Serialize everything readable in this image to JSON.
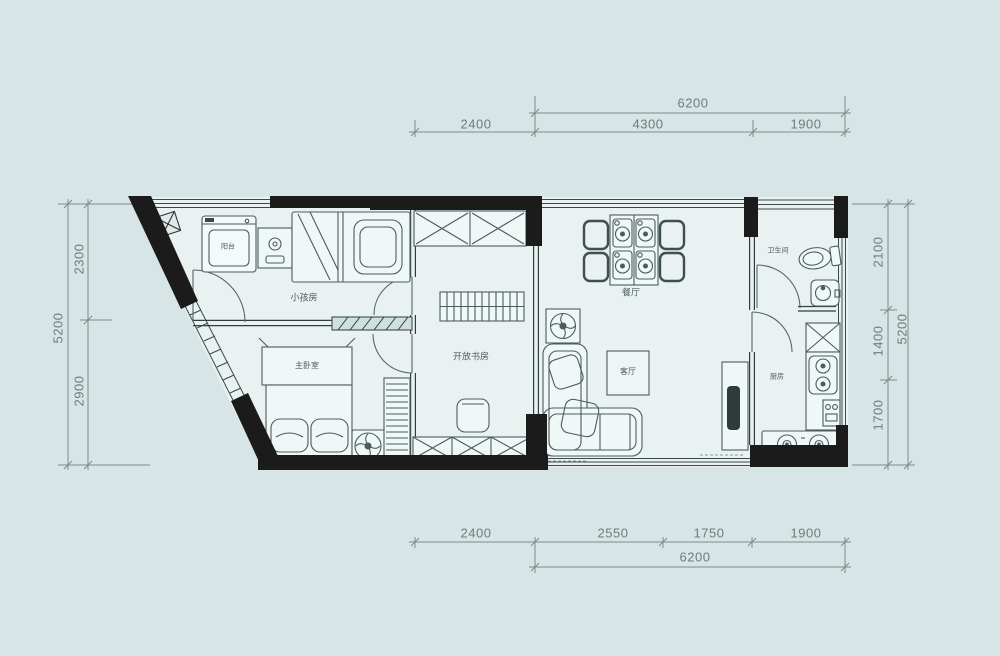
{
  "page": {
    "background": "#d7e5e6",
    "type": "apartment-floor-plan"
  },
  "plan": {
    "rooms": [
      {
        "key": "balcony",
        "label": "阳台"
      },
      {
        "key": "kids_room",
        "label": "小孩房"
      },
      {
        "key": "master_bedroom",
        "label": "主卧室"
      },
      {
        "key": "open_study",
        "label": "开放书房"
      },
      {
        "key": "dining_room",
        "label": "餐厅"
      },
      {
        "key": "living_room",
        "label": "客厅"
      },
      {
        "key": "bathroom",
        "label": "卫生间"
      },
      {
        "key": "kitchen",
        "label": "厨房"
      }
    ]
  },
  "dimensions": {
    "top": {
      "overall": "6200",
      "segments": [
        "2400",
        "4300",
        "1900"
      ]
    },
    "bottom": {
      "overall": "6200",
      "segments": [
        "2400",
        "2550",
        "1750",
        "1900"
      ]
    },
    "left": {
      "overall": "5200",
      "segments": [
        "2300",
        "2900"
      ]
    },
    "right": {
      "overall": "5200",
      "segments": [
        "2100",
        "1400",
        "1700"
      ]
    }
  },
  "colors": {
    "background": "#d7e5e6",
    "floor": "#e9f2f1",
    "wall": "#1b1b1b",
    "furniture_line": "#4c5c5c",
    "dimension_line": "#7d8a8a"
  }
}
